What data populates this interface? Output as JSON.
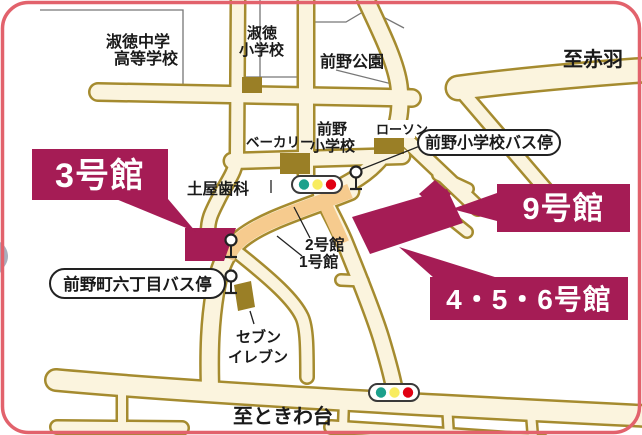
{
  "map": {
    "type": "campus access map",
    "banners": {
      "bldg3": "3号館",
      "bldg9": "9号館",
      "bldg456": "4・5・6号館"
    },
    "bus_stop_labels": {
      "maeno_shogakko": "前野小学校バス停",
      "maenocho_6chome": "前野町六丁目バス停"
    },
    "labels": {
      "shukutoku_jh_line1": "淑徳中学",
      "shukutoku_jh_line2": "高等学校",
      "shukutoku_elem_line1": "淑徳",
      "shukutoku_elem_line2": "小学校",
      "maeno_park": "前野公園",
      "maeno_elem_line1": "前野",
      "maeno_elem_line2": "小学校",
      "bakery": "ベーカリー",
      "lawson": "ローソン",
      "tsuchiya_dental": "土屋歯科",
      "bldg2": "2号館",
      "bldg1": "1号館",
      "seven_line1": "セブン",
      "seven_line2": "イレブン",
      "to_akabane": "至赤羽",
      "to_tokiwadai": "至ときわ台"
    },
    "icons": {
      "traffic_light": "traffic-light (green/yellow/red)",
      "bus_stop": "bus-stop pole sign"
    },
    "colors": {
      "border": "#E2626C",
      "building_accent": "#A51C55",
      "road_outline": "#A58B2F",
      "road_fill": "#FBF4DE",
      "route_highlight": "#F6CB8E",
      "landmark_building": "#9A7F26",
      "signal_green": "#1CA08C",
      "signal_yellow": "#F8EC60",
      "signal_red": "#E00012"
    }
  }
}
